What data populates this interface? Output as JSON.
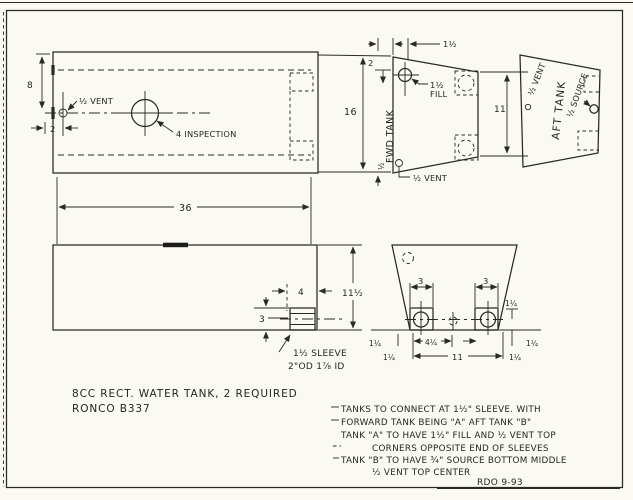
{
  "colors": {
    "paper": "#faf9f4",
    "ink": "#2a2922"
  },
  "plan_view": {
    "dim_height": "8",
    "dim_vent_offset": "2",
    "dim_length": "36",
    "vent_label": "½ VENT",
    "inspection_label": "4 INSPECTION"
  },
  "fwd_tank_view": {
    "name": "FWD TANK",
    "dim_left_height": "16",
    "dim_top_offset": "1½",
    "dim_fill_from_top": "2",
    "fill_line1": "1½",
    "fill_line2": "FILL",
    "vent_offset": "½",
    "vent_label": "½ VENT",
    "dim_right_height": "11"
  },
  "aft_tank_view": {
    "name": "AFT TANK",
    "vent_label": "½ VENT",
    "source_label": "½ SOURCE"
  },
  "side_view": {
    "dim_height": "11½",
    "dim_sleeve_inset": "4",
    "dim_sleeve_height": "3",
    "sleeve_line1": "1½ SLEEVE",
    "sleeve_line2": "2\"OD  1⅞ ID"
  },
  "end_view": {
    "dim_port": "3",
    "dim_stbd": "3",
    "dim_center": "4¼",
    "dim_width": "11",
    "dim_corner_a": "1¼",
    "dim_corner_b": "1¼",
    "dim_corner_c": "1¼",
    "dim_corner_d": "1¼",
    "dim_circle_height": "1¼"
  },
  "title_block": {
    "line1": "8CC  RECT. WATER TANK,  2  REQUIRED",
    "line2": "RONCO   B337"
  },
  "notes": {
    "lines": [
      "TANKS TO CONNECT AT 1½\" SLEEVE.  WITH",
      "FORWARD TANK BEING \"A\" AFT TANK \"B\"",
      "TANK \"A\" TO HAVE  1½\" FILL AND ½ VENT TOP",
      "CORNERS OPPOSITE END OF SLEEVES",
      "TANK \"B\" TO HAVE ¾\" SOURCE BOTTOM MIDDLE",
      "½ VENT  TOP CENTER"
    ]
  },
  "signature": "RDO  9-93"
}
